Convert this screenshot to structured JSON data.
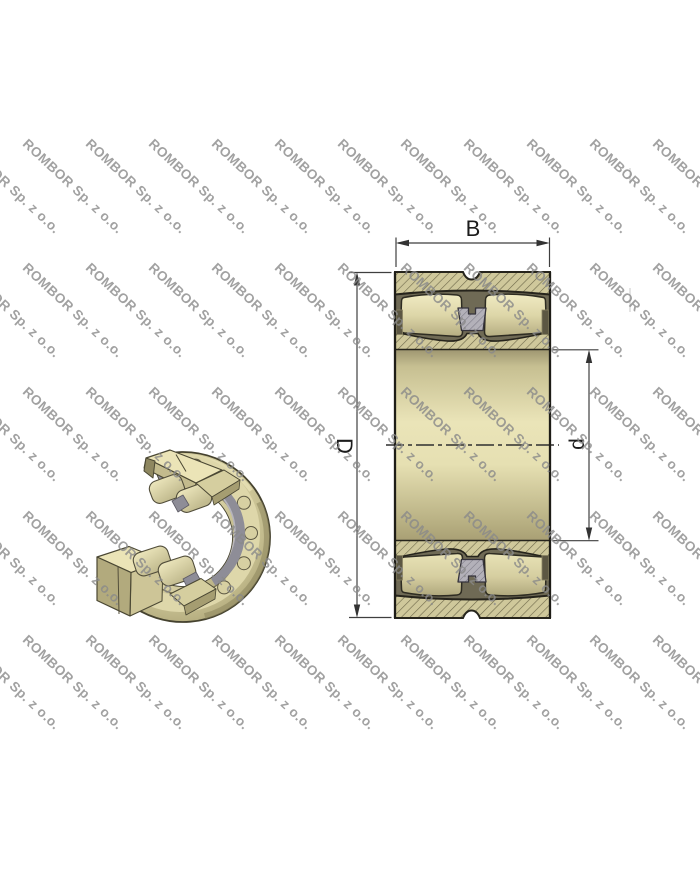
{
  "image": {
    "width": 700,
    "height": 869,
    "background": "#ffffff"
  },
  "watermark": {
    "text": "ROMBOR Sp. z o.o.",
    "color": "#8a8a8a",
    "opacity": 0.8,
    "angle_deg": 43,
    "font_size_px": 13.5,
    "grid": {
      "x_start": -33,
      "x_step": 63,
      "cols": 12,
      "y_start": 136,
      "y_step": 124,
      "rows": 5
    }
  },
  "dimensions": {
    "width_label": "B",
    "outer_diameter_label": "D",
    "bore_diameter_label": "d"
  },
  "colors": {
    "bearing_tan": "#d0c99b",
    "bearing_tan_light": "#ece6ba",
    "bearing_tan_dark": "#a89f74",
    "hatch_line": "#6e684a",
    "cage_gray": "#8e8d97",
    "cage_hatch": "#7b7984",
    "pocket_dark": "#6f6a55",
    "outline": "#1e1d17",
    "dimension_line": "#3f3f3f",
    "watermark_gray": "#8a8a8a",
    "stray_mark": "#c9c9c9"
  }
}
